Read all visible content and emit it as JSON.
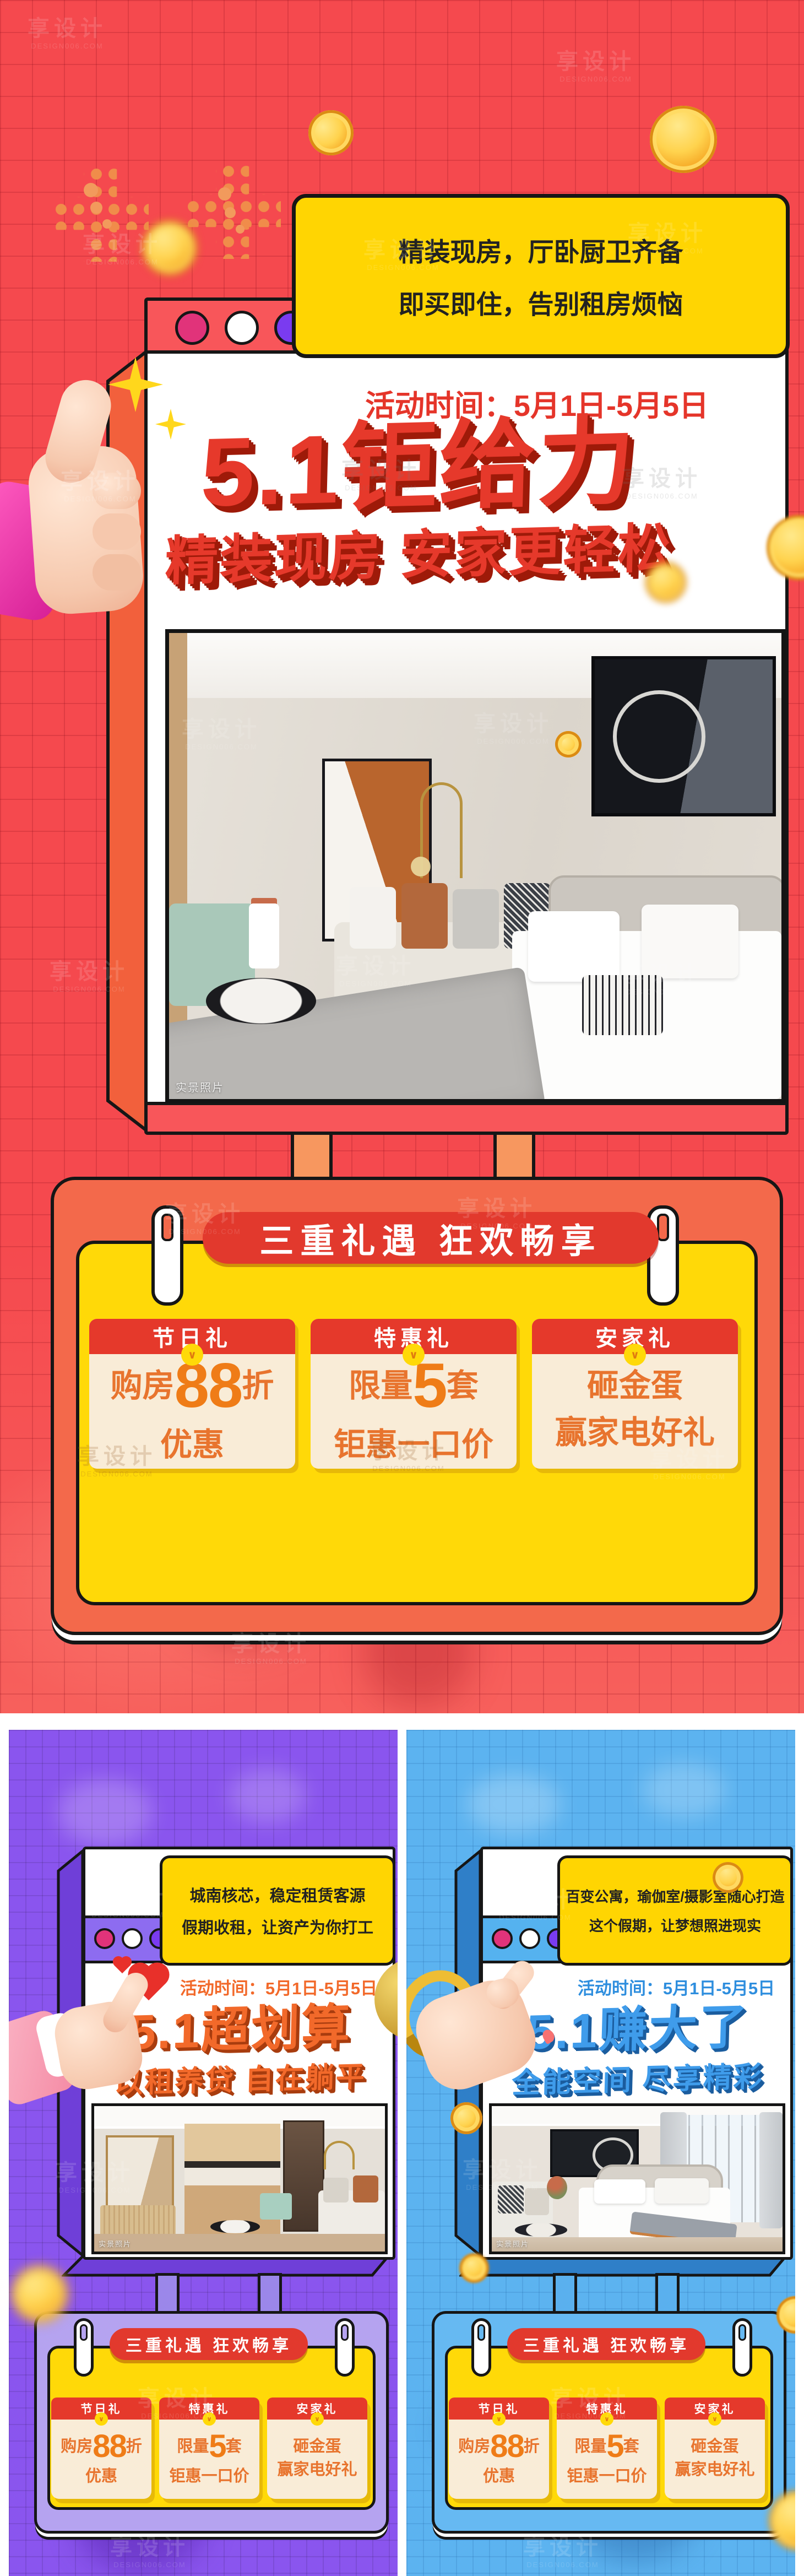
{
  "watermark": {
    "brand": "享设计",
    "site": "DESIGN006.COM"
  },
  "shared": {
    "event_time": "活动时间：5月1日-5月5日",
    "pill": "三重礼遇 狂欢畅享",
    "photo_tag": "实景照片",
    "cards": [
      {
        "label": "节日礼",
        "pre": "购房",
        "big": "88",
        "post": "折",
        "line2": "优惠"
      },
      {
        "label": "特惠礼",
        "pre": "限量",
        "big": "5",
        "post": "套",
        "line2": "钜惠一口价"
      },
      {
        "label": "安家礼",
        "pre": "砸金蛋",
        "big": "",
        "post": "",
        "line2": "赢家电好礼"
      }
    ]
  },
  "main": {
    "bubble1": "精装现房，厅卧厨卫齐备",
    "bubble2": "即买即住，告别租房烦恼",
    "title": "5.1钜给力",
    "subtitle": "精装现房 安家更轻松"
  },
  "left": {
    "bubble1": "城南核芯，稳定租赁客源",
    "bubble2": "假期收租，让资产为你打工",
    "title": "5.1超划算",
    "subtitle": "以租养贷 自在躺平"
  },
  "right": {
    "bubble1": "百变公寓，瑜伽室/摄影室随心打造",
    "bubble2": "这个假期，让梦想照进现实",
    "title": "5.1赚大了",
    "subtitle": "全能空间 尽享精彩"
  },
  "icons": {
    "chevron_down": "∨"
  },
  "colors": {
    "main_red": "#f5494e",
    "purple": "#8a55ee",
    "blue": "#5cb3f0",
    "yellow": "#ffd908",
    "bubble_yellow": "#ffd502",
    "card_red": "#e5392b",
    "card_cream": "#f9ecd7",
    "card_text_orange": "#e8742e"
  }
}
